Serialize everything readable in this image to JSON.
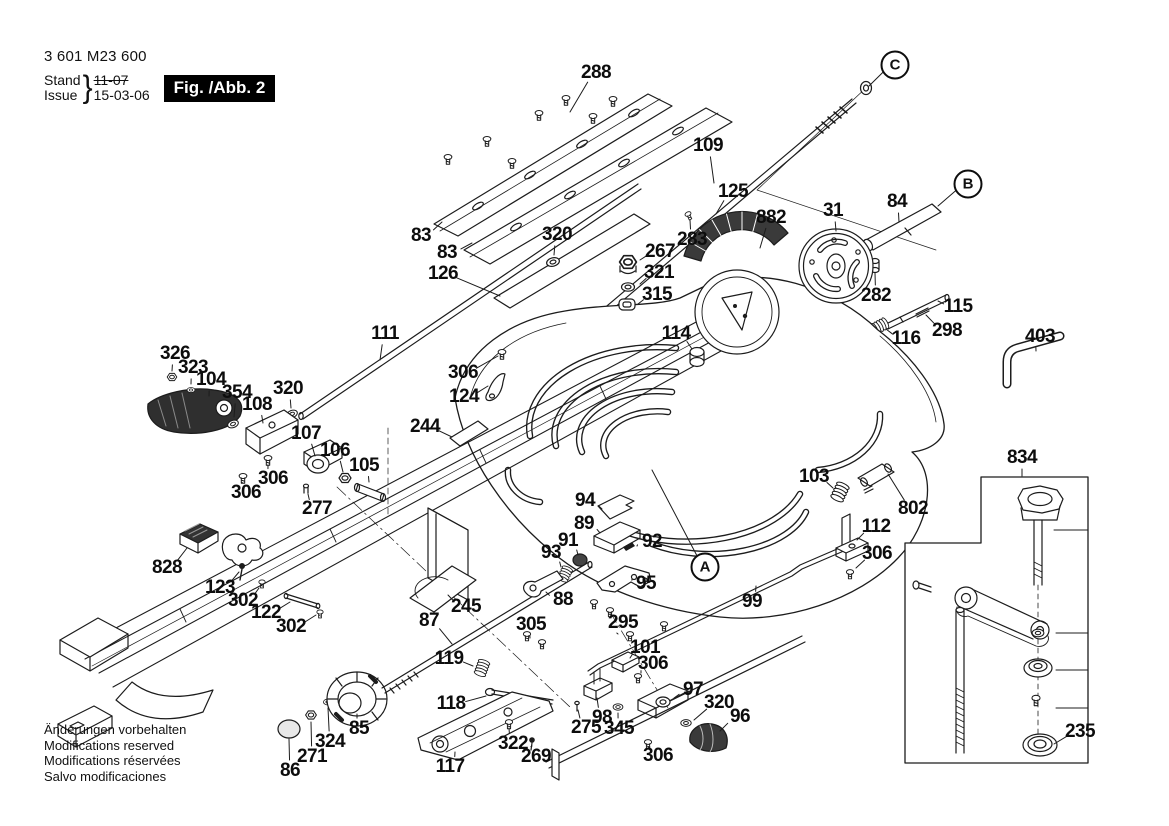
{
  "meta": {
    "part_number": "3 601 M23 600",
    "stand_label": "Stand",
    "issue_label": "Issue",
    "brace": "}",
    "superseded_date": "11-07",
    "issue_date": "15-03-06",
    "figure_label": "Fig. /Abb. 2"
  },
  "footnotes": [
    "Änderungen vorbehalten",
    "Modifications reserved",
    "Modifications réservées",
    "Salvo modificaciones"
  ],
  "colors": {
    "ink": "#1c1c1c",
    "background": "#ffffff",
    "fig_box_bg": "#000000",
    "fig_box_text": "#ffffff"
  },
  "ref_markers": [
    {
      "t": "A",
      "x": 705,
      "y": 567,
      "lx": 652,
      "ly": 470
    },
    {
      "t": "B",
      "x": 968,
      "y": 184,
      "lx": 938,
      "ly": 206
    },
    {
      "t": "C",
      "x": 895,
      "y": 65,
      "lx": 869,
      "ly": 86
    }
  ],
  "part_labels": [
    {
      "t": "288",
      "x": 596,
      "y": 73,
      "lx": 570,
      "ly": 112
    },
    {
      "t": "109",
      "x": 708,
      "y": 146,
      "lx": 714,
      "ly": 183
    },
    {
      "t": "125",
      "x": 733,
      "y": 192,
      "lx": 716,
      "ly": 214
    },
    {
      "t": "882",
      "x": 771,
      "y": 218,
      "lx": 760,
      "ly": 248
    },
    {
      "t": "31",
      "x": 833,
      "y": 211,
      "lx": 836,
      "ly": 231
    },
    {
      "t": "84",
      "x": 897,
      "y": 202,
      "lx": 899,
      "ly": 222
    },
    {
      "t": "283",
      "x": 692,
      "y": 240,
      "lx": 690,
      "ly": 220
    },
    {
      "t": "267",
      "x": 660,
      "y": 252,
      "lx": 640,
      "ly": 260
    },
    {
      "t": "321",
      "x": 659,
      "y": 273,
      "lx": 640,
      "ly": 284
    },
    {
      "t": "315",
      "x": 657,
      "y": 295,
      "lx": 638,
      "ly": 304
    },
    {
      "t": "320",
      "x": 557,
      "y": 235,
      "lx": 554,
      "ly": 255
    },
    {
      "t": "83",
      "x": 421,
      "y": 236,
      "lx": 442,
      "ly": 222
    },
    {
      "t": "83",
      "x": 447,
      "y": 253,
      "lx": 472,
      "ly": 243
    },
    {
      "t": "126",
      "x": 443,
      "y": 274,
      "lx": 500,
      "ly": 296
    },
    {
      "t": "111",
      "x": 385,
      "y": 334,
      "lx": 380,
      "ly": 360
    },
    {
      "t": "114",
      "x": 676,
      "y": 334,
      "lx": 692,
      "ly": 349
    },
    {
      "t": "282",
      "x": 876,
      "y": 296,
      "lx": 875,
      "ly": 273
    },
    {
      "t": "115",
      "x": 958,
      "y": 307,
      "lx": 938,
      "ly": 301
    },
    {
      "t": "116",
      "x": 906,
      "y": 339,
      "lx": 886,
      "ly": 329
    },
    {
      "t": "298",
      "x": 947,
      "y": 331,
      "lx": 926,
      "ly": 315
    },
    {
      "t": "403",
      "x": 1040,
      "y": 337,
      "lx": 1036,
      "ly": 351
    },
    {
      "t": "326",
      "x": 175,
      "y": 354,
      "lx": 172,
      "ly": 371
    },
    {
      "t": "323",
      "x": 193,
      "y": 368,
      "lx": 191,
      "ly": 384
    },
    {
      "t": "104",
      "x": 211,
      "y": 380,
      "lx": 209,
      "ly": 396
    },
    {
      "t": "354",
      "x": 237,
      "y": 393,
      "lx": 234,
      "ly": 417
    },
    {
      "t": "108",
      "x": 257,
      "y": 405,
      "lx": 263,
      "ly": 423
    },
    {
      "t": "320",
      "x": 288,
      "y": 389,
      "lx": 291,
      "ly": 408
    },
    {
      "t": "107",
      "x": 306,
      "y": 434,
      "lx": 315,
      "ly": 456
    },
    {
      "t": "106",
      "x": 335,
      "y": 451,
      "lx": 343,
      "ly": 472
    },
    {
      "t": "105",
      "x": 364,
      "y": 466,
      "lx": 369,
      "ly": 482
    },
    {
      "t": "306",
      "x": 273,
      "y": 479,
      "lx": 268,
      "ly": 465
    },
    {
      "t": "306",
      "x": 246,
      "y": 493,
      "lx": 243,
      "ly": 483
    },
    {
      "t": "277",
      "x": 317,
      "y": 509,
      "lx": 308,
      "ly": 494
    },
    {
      "t": "244",
      "x": 425,
      "y": 427,
      "lx": 452,
      "ly": 437
    },
    {
      "t": "306",
      "x": 463,
      "y": 373,
      "lx": 498,
      "ly": 356
    },
    {
      "t": "124",
      "x": 464,
      "y": 397,
      "lx": 488,
      "ly": 386
    },
    {
      "t": "94",
      "x": 585,
      "y": 501,
      "lx": 602,
      "ly": 509
    },
    {
      "t": "89",
      "x": 584,
      "y": 524,
      "lx": 600,
      "ly": 533
    },
    {
      "t": "91",
      "x": 568,
      "y": 541,
      "lx": 578,
      "ly": 555
    },
    {
      "t": "92",
      "x": 652,
      "y": 542,
      "lx": 637,
      "ly": 546
    },
    {
      "t": "93",
      "x": 551,
      "y": 553,
      "lx": 561,
      "ly": 567
    },
    {
      "t": "95",
      "x": 646,
      "y": 584,
      "lx": 632,
      "ly": 579
    },
    {
      "t": "88",
      "x": 563,
      "y": 600,
      "lx": 546,
      "ly": 592
    },
    {
      "t": "103",
      "x": 814,
      "y": 477,
      "lx": 833,
      "ly": 488
    },
    {
      "t": "112",
      "x": 876,
      "y": 527,
      "lx": 857,
      "ly": 540
    },
    {
      "t": "802",
      "x": 913,
      "y": 509,
      "lx": 888,
      "ly": 474
    },
    {
      "t": "306",
      "x": 877,
      "y": 554,
      "lx": 856,
      "ly": 568
    },
    {
      "t": "828",
      "x": 167,
      "y": 568,
      "lx": 187,
      "ly": 548
    },
    {
      "t": "123",
      "x": 220,
      "y": 588,
      "lx": 239,
      "ly": 572
    },
    {
      "t": "302",
      "x": 243,
      "y": 601,
      "lx": 259,
      "ly": 588
    },
    {
      "t": "122",
      "x": 266,
      "y": 613,
      "lx": 290,
      "ly": 602
    },
    {
      "t": "302",
      "x": 291,
      "y": 627,
      "lx": 316,
      "ly": 615
    },
    {
      "t": "87",
      "x": 429,
      "y": 621,
      "lx": 452,
      "ly": 644
    },
    {
      "t": "245",
      "x": 466,
      "y": 607,
      "lx": 448,
      "ly": 595
    },
    {
      "t": "305",
      "x": 531,
      "y": 625,
      "lx": 530,
      "ly": 638
    },
    {
      "t": "295",
      "x": 623,
      "y": 623,
      "lx": 618,
      "ly": 634
    },
    {
      "t": "99",
      "x": 752,
      "y": 602,
      "lx": 756,
      "ly": 586
    },
    {
      "t": "119",
      "x": 449,
      "y": 659,
      "lx": 473,
      "ly": 666
    },
    {
      "t": "101",
      "x": 645,
      "y": 648,
      "lx": 630,
      "ly": 658
    },
    {
      "t": "306",
      "x": 653,
      "y": 664,
      "lx": 641,
      "ly": 673
    },
    {
      "t": "118",
      "x": 451,
      "y": 704,
      "lx": 486,
      "ly": 696
    },
    {
      "t": "97",
      "x": 693,
      "y": 690,
      "lx": 674,
      "ly": 698
    },
    {
      "t": "320",
      "x": 719,
      "y": 703,
      "lx": 694,
      "ly": 720
    },
    {
      "t": "96",
      "x": 740,
      "y": 717,
      "lx": 720,
      "ly": 731
    },
    {
      "t": "98",
      "x": 602,
      "y": 718,
      "lx": 597,
      "ly": 698
    },
    {
      "t": "275",
      "x": 586,
      "y": 728,
      "lx": 578,
      "ly": 710
    },
    {
      "t": "345",
      "x": 619,
      "y": 729,
      "lx": 618,
      "ly": 713
    },
    {
      "t": "306",
      "x": 658,
      "y": 756,
      "lx": 650,
      "ly": 747
    },
    {
      "t": "85",
      "x": 359,
      "y": 729,
      "lx": 357,
      "ly": 714
    },
    {
      "t": "324",
      "x": 330,
      "y": 742,
      "lx": 328,
      "ly": 708
    },
    {
      "t": "271",
      "x": 312,
      "y": 757,
      "lx": 311,
      "ly": 722
    },
    {
      "t": "86",
      "x": 290,
      "y": 771,
      "lx": 289,
      "ly": 739
    },
    {
      "t": "117",
      "x": 450,
      "y": 767,
      "lx": 455,
      "ly": 752
    },
    {
      "t": "322",
      "x": 513,
      "y": 744,
      "lx": 509,
      "ly": 728
    },
    {
      "t": "269",
      "x": 536,
      "y": 757,
      "lx": 532,
      "ly": 746
    },
    {
      "t": "834",
      "x": 1022,
      "y": 458,
      "lx": 1022,
      "ly": 476
    },
    {
      "t": "235",
      "x": 1080,
      "y": 732,
      "lx": 1054,
      "ly": 744
    }
  ]
}
